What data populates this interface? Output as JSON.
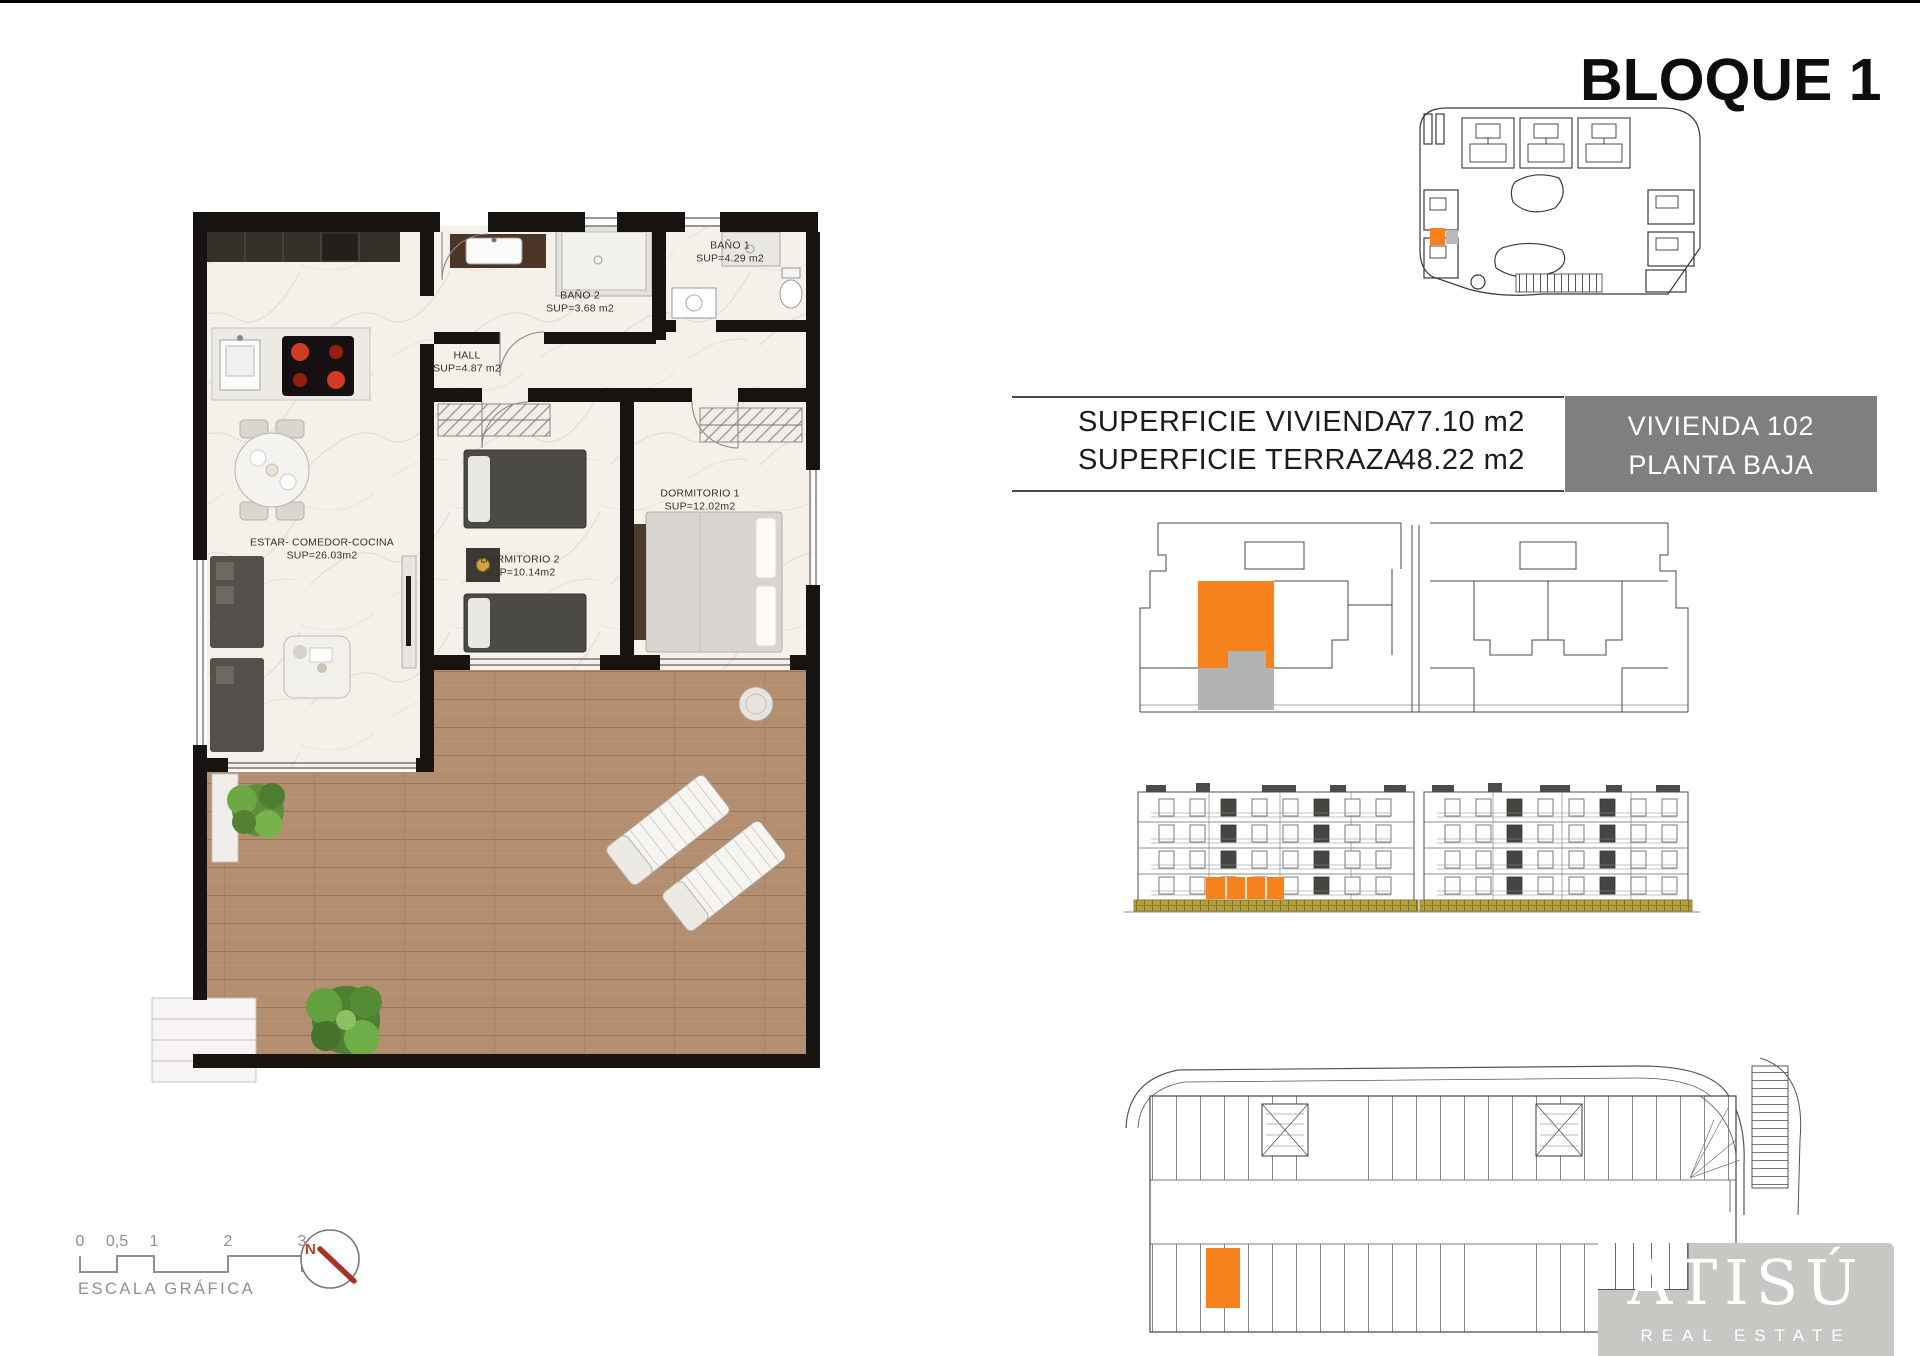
{
  "header": {
    "title": "BLOQUE 1"
  },
  "info": {
    "row1": {
      "label": "SUPERFICIE VIVIENDA",
      "value": "77.10 m2"
    },
    "row2": {
      "label": "SUPERFICIE TERRAZA",
      "value": "48.22 m2"
    },
    "unit": {
      "line1": "VIVIENDA 102",
      "line2": "PLANTA BAJA"
    }
  },
  "plan": {
    "estar": {
      "name": "ESTAR- COMEDOR-COCINA",
      "sup": "SUP=26.03m2"
    },
    "hall": {
      "name": "HALL",
      "sup": "SUP=4.87 m2"
    },
    "bano1": {
      "name": "BAÑO 1",
      "sup": "SUP=4.29 m2"
    },
    "bano2": {
      "name": "BAÑO 2",
      "sup": "SUP=3.68 m2"
    },
    "dorm1": {
      "name": "DORMITORIO 1",
      "sup": "SUP=12.02m2"
    },
    "dorm2": {
      "name": "DORMITORIO 2",
      "sup": "SUP=10.14m2"
    }
  },
  "scale_bar": {
    "ticks": [
      "0",
      "0,5",
      "1",
      "2",
      "3"
    ],
    "label": "ESCALA GRÁFICA"
  },
  "compass": {
    "n": "N"
  },
  "logo": {
    "name": "ATISÚ",
    "subtitle": "REAL ESTATE"
  },
  "colors": {
    "accent_orange": "#F6821E",
    "patio_gray": "#B3B3B3",
    "unit_box_gray": "#7F7F7F",
    "logo_panel_gray": "#C9C7C4",
    "terrace_wood": "#B28C6E",
    "base_olive": "#B3A03C",
    "compass_red": "#C0392B"
  }
}
